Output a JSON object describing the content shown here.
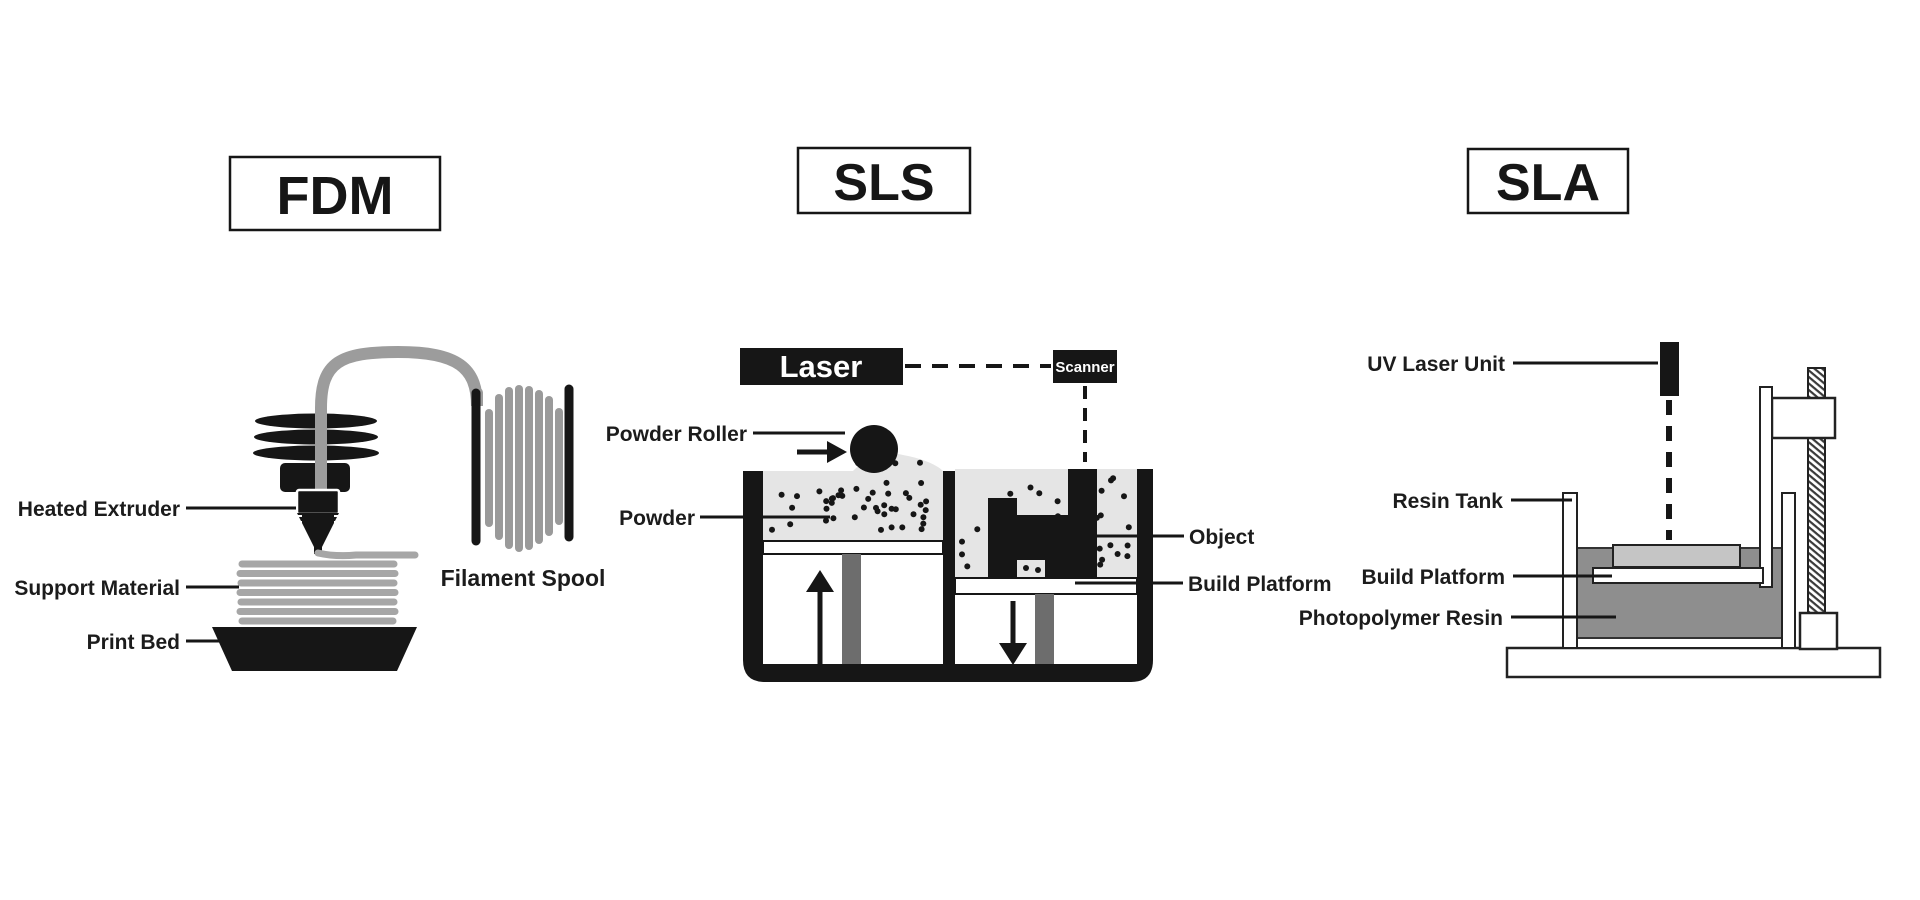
{
  "page": {
    "background": "#ffffff",
    "description": "Comparison diagram of three 3D printing technologies"
  },
  "colors": {
    "ink": "#161616",
    "label": "#1c1c1c",
    "white": "#ffffff",
    "powder": "#e5e5e5",
    "tube_gray": "#9c9c9c",
    "support_gray": "#a6a6a6",
    "piston_gray": "#6d6d6d",
    "resin_gray": "#8e8e8e",
    "cured_gray": "#c5c5c5"
  },
  "panels": {
    "fdm": {
      "title": "FDM",
      "labels": {
        "heated_extruder": "Heated Extruder",
        "support_material": "Support Material",
        "print_bed": "Print Bed",
        "filament_spool": "Filament Spool"
      }
    },
    "sls": {
      "title": "SLS",
      "laser_label": "Laser",
      "scanner_label": "Scanner",
      "labels": {
        "powder_roller": "Powder Roller",
        "powder": "Powder",
        "object": "Object",
        "build_platform": "Build Platform"
      }
    },
    "sla": {
      "title": "SLA",
      "labels": {
        "uv_laser_unit": "UV Laser Unit",
        "resin_tank": "Resin Tank",
        "build_platform": "Build Platform",
        "photopolymer_resin": "Photopolymer Resin"
      }
    }
  }
}
